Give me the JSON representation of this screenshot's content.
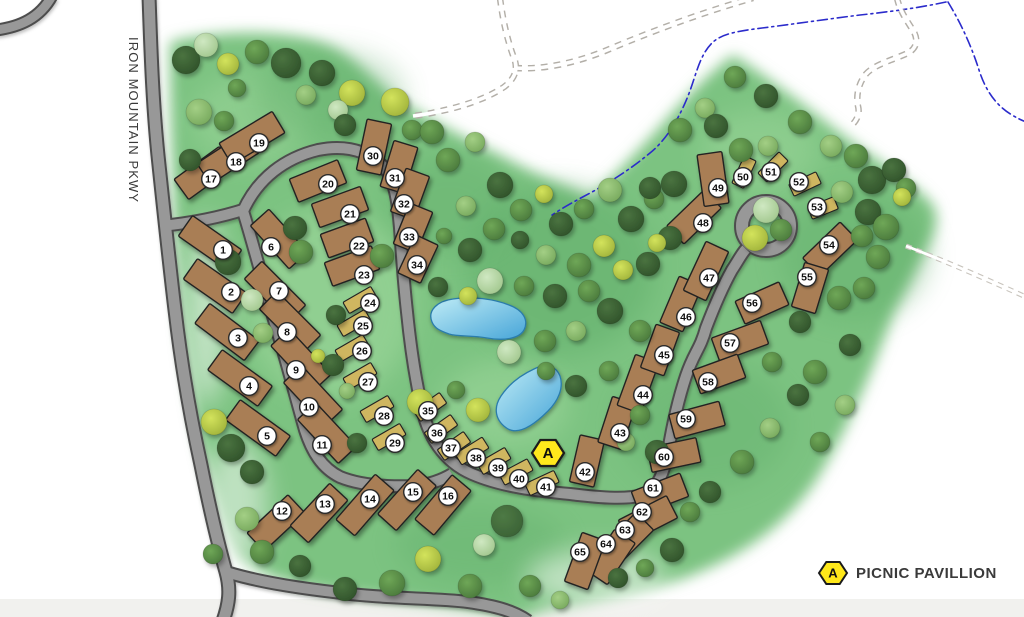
{
  "road_label": "IRON MOUNTAIN PKWY",
  "legend": {
    "symbol": "A",
    "label": "PICNIC PAVILLION"
  },
  "pavilion_markers": [
    {
      "x": 548,
      "y": 453
    }
  ],
  "colors": {
    "grass": "#7cc381",
    "grassDark": "#58a763",
    "grassLight": "#aadfa5",
    "white": "#ffffff",
    "roadFill": "#989898",
    "roadEdge": "#4e4e4e",
    "trail": "#b3afa8",
    "trailFaint": "#c8c4bd",
    "stream": "#2b2bcb",
    "pondLight": "#bfecf6",
    "pondDark": "#47a5d8",
    "pondStroke": "#2a7bab",
    "rvSite": "#a97e54",
    "tentSite": "#cfb660",
    "siteStroke": "#222222",
    "badgeFill": "#ffffff",
    "badgeStroke": "#2b2b2b",
    "badgeText": "#111111",
    "pavilionFill": "#ffe81a",
    "pavilionStroke": "#1a1a1a",
    "labelText": "#3a3a3a",
    "bottomBand": "#f0efec"
  },
  "tree_colors": {
    "dk": [
      "#4a7340",
      "#2f5129"
    ],
    "md": [
      "#6fa757",
      "#49783b"
    ],
    "lt": [
      "#a3cf85",
      "#76a85c"
    ],
    "pale": [
      "#cfe8c2",
      "#a0c68c"
    ],
    "yg": [
      "#d3e35c",
      "#9fb23a"
    ],
    "dk2": [
      "#4e7a45",
      "#3a6135"
    ]
  },
  "sites": [
    [
      1,
      210,
      243,
      35,
      60,
      "r",
      223,
      250
    ],
    [
      2,
      215,
      286,
      35,
      60,
      "r",
      231,
      292
    ],
    [
      3,
      227,
      332,
      37,
      62,
      "r",
      238,
      338
    ],
    [
      4,
      240,
      378,
      36,
      62,
      "r",
      249,
      386
    ],
    [
      5,
      258,
      428,
      36,
      62,
      "r",
      267,
      436
    ],
    [
      6,
      279,
      239,
      48,
      58,
      "r",
      271,
      247
    ],
    [
      7,
      275,
      292,
      45,
      62,
      "r",
      279,
      291
    ],
    [
      8,
      290,
      322,
      45,
      62,
      "r",
      287,
      332
    ],
    [
      9,
      301,
      360,
      47,
      62,
      "r",
      296,
      370
    ],
    [
      10,
      313,
      396,
      47,
      60,
      "r",
      309,
      407
    ],
    [
      11,
      327,
      433,
      47,
      60,
      "r",
      322,
      445
    ],
    [
      12,
      276,
      523,
      -43,
      56,
      "r",
      282,
      511
    ],
    [
      13,
      319,
      513,
      -47,
      58,
      "r",
      325,
      504
    ],
    [
      14,
      365,
      505,
      -49,
      60,
      "r",
      370,
      499
    ],
    [
      15,
      407,
      500,
      -48,
      60,
      "r",
      413,
      492
    ],
    [
      16,
      443,
      505,
      -50,
      58,
      "r",
      448,
      496
    ],
    [
      17,
      204,
      173,
      -36,
      56,
      "r",
      211,
      179
    ],
    [
      18,
      228,
      158,
      -33,
      58,
      "r",
      236,
      162
    ],
    [
      19,
      252,
      138,
      -31,
      62,
      "r",
      259,
      143
    ],
    [
      20,
      318,
      181,
      -22,
      52,
      "r",
      328,
      184
    ],
    [
      21,
      340,
      207,
      -20,
      52,
      "r",
      350,
      214
    ],
    [
      22,
      347,
      238,
      -20,
      48,
      "r",
      359,
      246
    ],
    [
      23,
      352,
      266,
      -20,
      50,
      "r",
      364,
      275
    ],
    [
      24,
      360,
      300,
      -30,
      32,
      "t",
      370,
      303
    ],
    [
      25,
      354,
      323,
      -30,
      32,
      "t",
      363,
      326
    ],
    [
      26,
      352,
      348,
      -30,
      32,
      "t",
      362,
      351
    ],
    [
      27,
      360,
      376,
      -30,
      32,
      "t",
      368,
      382
    ],
    [
      28,
      377,
      409,
      -30,
      32,
      "t",
      384,
      416
    ],
    [
      29,
      389,
      437,
      -30,
      32,
      "t",
      395,
      443
    ],
    [
      30,
      374,
      147,
      -78,
      52,
      "r",
      373,
      156
    ],
    [
      31,
      399,
      167,
      -73,
      48,
      "r",
      395,
      178
    ],
    [
      32,
      410,
      194,
      -70,
      46,
      "r",
      404,
      204
    ],
    [
      33,
      413,
      228,
      -68,
      44,
      "r",
      409,
      237
    ],
    [
      34,
      418,
      259,
      -65,
      42,
      "r",
      417,
      265
    ],
    [
      35,
      430,
      407,
      -35,
      32,
      "t",
      428,
      411
    ],
    [
      36,
      441,
      429,
      -35,
      32,
      "t",
      437,
      433
    ],
    [
      37,
      454,
      446,
      -35,
      32,
      "t",
      451,
      448
    ],
    [
      38,
      472,
      451,
      -32,
      32,
      "t",
      476,
      458
    ],
    [
      39,
      494,
      461,
      -30,
      32,
      "t",
      498,
      468
    ],
    [
      40,
      516,
      472,
      -28,
      32,
      "t",
      519,
      479
    ],
    [
      41,
      542,
      483,
      -25,
      32,
      "t",
      546,
      487
    ],
    [
      42,
      587,
      461,
      -77,
      48,
      "r",
      585,
      472
    ],
    [
      43,
      617,
      423,
      -72,
      48,
      "r",
      620,
      433
    ],
    [
      44,
      638,
      384,
      -70,
      54,
      "r",
      643,
      395
    ],
    [
      45,
      660,
      350,
      -70,
      46,
      "r",
      664,
      355
    ],
    [
      46,
      681,
      304,
      -67,
      50,
      "r",
      686,
      317
    ],
    [
      47,
      706,
      271,
      -65,
      54,
      "r",
      709,
      278
    ],
    [
      48,
      694,
      217,
      -44,
      52,
      "r",
      703,
      223
    ],
    [
      49,
      713,
      179,
      82,
      52,
      "r",
      718,
      188
    ],
    [
      50,
      744,
      172,
      -65,
      30,
      "t",
      743,
      177
    ],
    [
      51,
      773,
      167,
      -45,
      30,
      "t",
      771,
      172
    ],
    [
      52,
      805,
      184,
      -25,
      30,
      "t",
      799,
      182
    ],
    [
      53,
      823,
      208,
      -22,
      28,
      "t",
      817,
      207
    ],
    [
      54,
      830,
      249,
      -44,
      52,
      "r",
      829,
      245
    ],
    [
      55,
      810,
      288,
      -73,
      46,
      "r",
      807,
      277
    ],
    [
      56,
      762,
      303,
      -24,
      48,
      "r",
      752,
      303
    ],
    [
      57,
      740,
      341,
      -20,
      52,
      "r",
      730,
      343
    ],
    [
      58,
      719,
      374,
      -20,
      48,
      "r",
      708,
      382
    ],
    [
      59,
      697,
      420,
      -15,
      52,
      "r",
      686,
      419
    ],
    [
      60,
      674,
      455,
      -12,
      50,
      "r",
      664,
      457
    ],
    [
      61,
      660,
      494,
      -21,
      52,
      "r",
      653,
      488
    ],
    [
      62,
      648,
      519,
      -27,
      54,
      "r",
      642,
      512
    ],
    [
      63,
      625,
      541,
      -45,
      56,
      "r",
      625,
      530
    ],
    [
      64,
      611,
      557,
      -56,
      50,
      "r",
      606,
      544
    ],
    [
      65,
      585,
      561,
      -70,
      52,
      "r",
      580,
      552
    ]
  ],
  "trees": [
    [
      186,
      60,
      14,
      "dk"
    ],
    [
      206,
      45,
      12,
      "pale"
    ],
    [
      228,
      64,
      11,
      "yg"
    ],
    [
      257,
      52,
      12,
      "md"
    ],
    [
      286,
      63,
      15,
      "dk"
    ],
    [
      237,
      88,
      9,
      "md"
    ],
    [
      199,
      112,
      13,
      "lt"
    ],
    [
      224,
      121,
      10,
      "md"
    ],
    [
      306,
      95,
      10,
      "lt"
    ],
    [
      322,
      73,
      13,
      "dk"
    ],
    [
      352,
      93,
      13,
      "yg"
    ],
    [
      338,
      110,
      10,
      "pale"
    ],
    [
      395,
      102,
      14,
      "yg"
    ],
    [
      345,
      125,
      11,
      "dk"
    ],
    [
      412,
      130,
      10,
      "md"
    ],
    [
      432,
      132,
      12,
      "md"
    ],
    [
      448,
      160,
      12,
      "md"
    ],
    [
      475,
      142,
      10,
      "lt"
    ],
    [
      500,
      185,
      13,
      "dk"
    ],
    [
      521,
      210,
      11,
      "md"
    ],
    [
      544,
      194,
      9,
      "yg"
    ],
    [
      561,
      224,
      12,
      "dk"
    ],
    [
      584,
      209,
      10,
      "md"
    ],
    [
      610,
      190,
      12,
      "lt"
    ],
    [
      631,
      219,
      13,
      "dk"
    ],
    [
      654,
      199,
      10,
      "md"
    ],
    [
      604,
      246,
      11,
      "yg"
    ],
    [
      579,
      265,
      12,
      "md"
    ],
    [
      546,
      255,
      10,
      "lt"
    ],
    [
      520,
      240,
      9,
      "dk"
    ],
    [
      494,
      229,
      11,
      "md"
    ],
    [
      466,
      206,
      10,
      "lt"
    ],
    [
      470,
      250,
      12,
      "dk"
    ],
    [
      444,
      236,
      8,
      "md"
    ],
    [
      490,
      281,
      13,
      "pale"
    ],
    [
      524,
      286,
      10,
      "md"
    ],
    [
      555,
      296,
      12,
      "dk"
    ],
    [
      589,
      291,
      11,
      "md"
    ],
    [
      623,
      270,
      10,
      "yg"
    ],
    [
      648,
      264,
      12,
      "dk"
    ],
    [
      610,
      311,
      13,
      "dk"
    ],
    [
      640,
      331,
      11,
      "md"
    ],
    [
      576,
      331,
      10,
      "lt"
    ],
    [
      545,
      341,
      11,
      "md"
    ],
    [
      509,
      352,
      12,
      "pale"
    ],
    [
      468,
      296,
      9,
      "yg"
    ],
    [
      438,
      287,
      10,
      "dk"
    ],
    [
      546,
      371,
      9,
      "md"
    ],
    [
      576,
      386,
      11,
      "dk"
    ],
    [
      609,
      371,
      10,
      "md"
    ],
    [
      420,
      402,
      13,
      "yg"
    ],
    [
      456,
      390,
      9,
      "md"
    ],
    [
      640,
      415,
      10,
      "md"
    ],
    [
      657,
      452,
      12,
      "dk"
    ],
    [
      626,
      442,
      9,
      "lt"
    ],
    [
      478,
      410,
      12,
      "yg"
    ],
    [
      190,
      160,
      11,
      "dk"
    ],
    [
      228,
      262,
      13,
      "dk"
    ],
    [
      252,
      300,
      11,
      "pale"
    ],
    [
      263,
      333,
      10,
      "lt"
    ],
    [
      214,
      422,
      13,
      "yg"
    ],
    [
      231,
      448,
      14,
      "dk"
    ],
    [
      252,
      472,
      12,
      "dk"
    ],
    [
      247,
      519,
      12,
      "lt"
    ],
    [
      262,
      552,
      12,
      "md"
    ],
    [
      300,
      566,
      11,
      "dk"
    ],
    [
      213,
      554,
      10,
      "md"
    ],
    [
      295,
      228,
      12,
      "dk"
    ],
    [
      301,
      252,
      12,
      "md"
    ],
    [
      382,
      256,
      12,
      "md"
    ],
    [
      333,
      365,
      11,
      "dk"
    ],
    [
      347,
      391,
      8,
      "lt"
    ],
    [
      357,
      443,
      10,
      "dk"
    ],
    [
      318,
      356,
      7,
      "yg"
    ],
    [
      336,
      315,
      10,
      "dk"
    ],
    [
      345,
      589,
      12,
      "dk"
    ],
    [
      392,
      583,
      13,
      "md"
    ],
    [
      428,
      559,
      13,
      "yg"
    ],
    [
      470,
      586,
      12,
      "md"
    ],
    [
      507,
      521,
      16,
      "dk2"
    ],
    [
      484,
      545,
      11,
      "pale"
    ],
    [
      530,
      586,
      11,
      "md"
    ],
    [
      560,
      600,
      9,
      "lt"
    ],
    [
      680,
      130,
      12,
      "md"
    ],
    [
      705,
      108,
      10,
      "lt"
    ],
    [
      716,
      126,
      12,
      "dk"
    ],
    [
      741,
      150,
      12,
      "md"
    ],
    [
      735,
      77,
      11,
      "md"
    ],
    [
      766,
      96,
      12,
      "dk"
    ],
    [
      800,
      122,
      12,
      "md"
    ],
    [
      831,
      146,
      11,
      "lt"
    ],
    [
      768,
      146,
      10,
      "lt"
    ],
    [
      856,
      156,
      12,
      "md"
    ],
    [
      872,
      180,
      14,
      "dk"
    ],
    [
      894,
      170,
      12,
      "dk"
    ],
    [
      906,
      188,
      10,
      "md"
    ],
    [
      868,
      212,
      13,
      "dk"
    ],
    [
      886,
      227,
      13,
      "md"
    ],
    [
      902,
      197,
      9,
      "yg"
    ],
    [
      878,
      257,
      12,
      "md"
    ],
    [
      864,
      288,
      11,
      "md"
    ],
    [
      842,
      192,
      11,
      "lt"
    ],
    [
      862,
      236,
      11,
      "md"
    ],
    [
      766,
      210,
      13,
      "pale"
    ],
    [
      755,
      238,
      13,
      "yg"
    ],
    [
      781,
      230,
      11,
      "md"
    ],
    [
      674,
      184,
      13,
      "dk"
    ],
    [
      650,
      188,
      11,
      "dk"
    ],
    [
      670,
      238,
      12,
      "dk"
    ],
    [
      657,
      243,
      9,
      "yg"
    ],
    [
      839,
      298,
      12,
      "md"
    ],
    [
      850,
      345,
      11,
      "dk"
    ],
    [
      815,
      372,
      12,
      "md"
    ],
    [
      845,
      405,
      10,
      "lt"
    ],
    [
      798,
      395,
      11,
      "dk"
    ],
    [
      772,
      362,
      10,
      "md"
    ],
    [
      770,
      428,
      10,
      "lt"
    ],
    [
      742,
      462,
      12,
      "md"
    ],
    [
      710,
      492,
      11,
      "dk"
    ],
    [
      820,
      442,
      10,
      "md"
    ],
    [
      800,
      322,
      11,
      "dk"
    ],
    [
      672,
      550,
      12,
      "dk"
    ],
    [
      690,
      512,
      10,
      "md"
    ],
    [
      618,
      578,
      10,
      "dk"
    ],
    [
      645,
      568,
      9,
      "md"
    ]
  ]
}
